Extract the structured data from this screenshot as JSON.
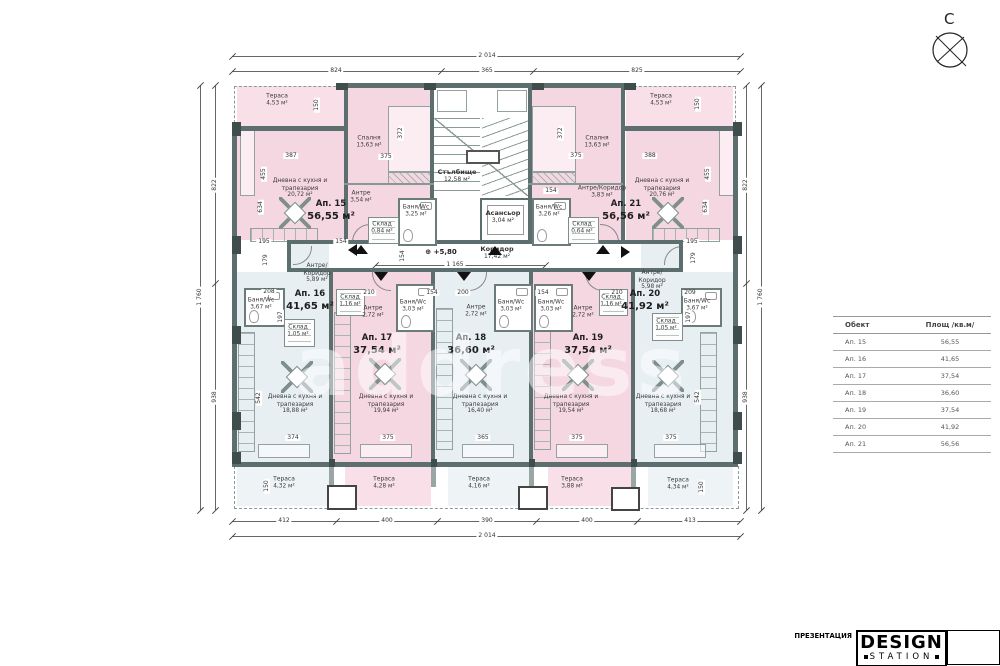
{
  "sheet": {
    "north": "С"
  },
  "watermark": "аddress",
  "core": {
    "stair": {
      "name": "Стълбище",
      "area": "12,58 м²"
    },
    "elevator": {
      "name": "Асансьор",
      "area": "3,04 м²"
    },
    "corridor": {
      "name": "Коридор",
      "area": "17,42 м²"
    },
    "level": "+5,80"
  },
  "apartments": [
    {
      "label": "Ап. 15",
      "area": "56,55 м²",
      "x": 331,
      "y": 211
    },
    {
      "label": "Ап. 16",
      "area": "41,65 м²",
      "x": 310,
      "y": 301
    },
    {
      "label": "Ап. 17",
      "area": "37,54 м²",
      "x": 377,
      "y": 345
    },
    {
      "label": "Ап. 18",
      "area": "36,60 м²",
      "x": 471,
      "y": 345
    },
    {
      "label": "Ап. 19",
      "area": "37,54 м²",
      "x": 588,
      "y": 345
    },
    {
      "label": "Ап. 20",
      "area": "41,92 м²",
      "x": 645,
      "y": 301
    },
    {
      "label": "Ап. 21",
      "area": "56,56 м²",
      "x": 626,
      "y": 211
    }
  ],
  "rooms": [
    {
      "name": "Тераса",
      "area": "4,53 м²",
      "x": 277,
      "y": 100
    },
    {
      "name": "Тераса",
      "area": "4,53 м²",
      "x": 661,
      "y": 100
    },
    {
      "name": "Спалня",
      "area": "13,63 м²",
      "x": 369,
      "y": 142
    },
    {
      "name": "Спалня",
      "area": "13,63 м²",
      "x": 597,
      "y": 142
    },
    {
      "name": "Дневна с кухня и\nтрапезария",
      "area": "20,72 м²",
      "x": 300,
      "y": 188
    },
    {
      "name": "Дневна с кухня и\nтрапезария",
      "area": "20,76 м²",
      "x": 662,
      "y": 188
    },
    {
      "name": "Антре",
      "area": "3,54 м²",
      "x": 361,
      "y": 197
    },
    {
      "name": "Антре/Коридор",
      "area": "3,83 м²",
      "x": 602,
      "y": 192
    },
    {
      "name": "Баня/Wc",
      "area": "3,25 м²",
      "x": 416,
      "y": 211
    },
    {
      "name": "Баня/Wc",
      "area": "3,26 м²",
      "x": 549,
      "y": 211
    },
    {
      "name": "Склад",
      "area": "0,84 м²",
      "x": 382,
      "y": 228
    },
    {
      "name": "Склад",
      "area": "0,64 м²",
      "x": 582,
      "y": 228
    },
    {
      "name": "Антре/\nКоридор",
      "area": "5,89 м²",
      "x": 317,
      "y": 273
    },
    {
      "name": "Антре/\nКоридор",
      "area": "5,98 м²",
      "x": 652,
      "y": 280
    },
    {
      "name": "Баня/Wc",
      "area": "3,67 м²",
      "x": 261,
      "y": 304
    },
    {
      "name": "Баня/Wc",
      "area": "3,67 м²",
      "x": 697,
      "y": 305
    },
    {
      "name": "Склад",
      "area": "1,05 м²",
      "x": 298,
      "y": 331
    },
    {
      "name": "Склад",
      "area": "1,05 м²",
      "x": 666,
      "y": 325
    },
    {
      "name": "Склад",
      "area": "1,16 м²",
      "x": 350,
      "y": 301
    },
    {
      "name": "Склад",
      "area": "1,16 м²",
      "x": 611,
      "y": 301
    },
    {
      "name": "Антре",
      "area": "2,72 м²",
      "x": 373,
      "y": 312
    },
    {
      "name": "Антре",
      "area": "2,72 м²",
      "x": 476,
      "y": 311
    },
    {
      "name": "Антре",
      "area": "2,72 м²",
      "x": 583,
      "y": 312
    },
    {
      "name": "Баня/Wc",
      "area": "3,03 м²",
      "x": 413,
      "y": 306
    },
    {
      "name": "Баня/Wc",
      "area": "3,03 м²",
      "x": 511,
      "y": 306
    },
    {
      "name": "Баня/Wc",
      "area": "3,03 м²",
      "x": 551,
      "y": 306
    },
    {
      "name": "Дневна с кухня и\nтрапезария",
      "area": "18,88 м²",
      "x": 295,
      "y": 404
    },
    {
      "name": "Дневна с кухня и\nтрапезария",
      "area": "19,94 м²",
      "x": 386,
      "y": 404
    },
    {
      "name": "Дневна с кухня и\nтрапезария",
      "area": "16,40 м²",
      "x": 480,
      "y": 404
    },
    {
      "name": "Дневна с кухня и\nтрапезария",
      "area": "19,54 м²",
      "x": 571,
      "y": 404
    },
    {
      "name": "Дневна с кухня и\nтрапезария",
      "area": "18,68 м²",
      "x": 663,
      "y": 404
    },
    {
      "name": "Тераса",
      "area": "4,32 м²",
      "x": 284,
      "y": 483
    },
    {
      "name": "Тераса",
      "area": "4,28 м²",
      "x": 384,
      "y": 483
    },
    {
      "name": "Тераса",
      "area": "4,16 м²",
      "x": 479,
      "y": 483
    },
    {
      "name": "Тераса",
      "area": "3,88 м²",
      "x": 572,
      "y": 483
    },
    {
      "name": "Тераса",
      "area": "4,34 м²",
      "x": 678,
      "y": 484
    }
  ],
  "dims": [
    {
      "t": "2 014",
      "x": 487,
      "y": 56
    },
    {
      "t": "824",
      "x": 336,
      "y": 71
    },
    {
      "t": "365",
      "x": 487,
      "y": 71
    },
    {
      "t": "825",
      "x": 637,
      "y": 71
    },
    {
      "t": "412",
      "x": 284,
      "y": 521
    },
    {
      "t": "400",
      "x": 387,
      "y": 521
    },
    {
      "t": "390",
      "x": 487,
      "y": 521
    },
    {
      "t": "400",
      "x": 587,
      "y": 521
    },
    {
      "t": "413",
      "x": 690,
      "y": 521
    },
    {
      "t": "2 014",
      "x": 487,
      "y": 536
    },
    {
      "t": "1 760",
      "x": 200,
      "y": 297,
      "v": 1
    },
    {
      "t": "822",
      "x": 215,
      "y": 185,
      "v": 1
    },
    {
      "t": "938",
      "x": 215,
      "y": 397,
      "v": 1
    },
    {
      "t": "822",
      "x": 746,
      "y": 185,
      "v": 1
    },
    {
      "t": "938",
      "x": 746,
      "y": 397,
      "v": 1
    },
    {
      "t": "1 760",
      "x": 761,
      "y": 297,
      "v": 1
    },
    {
      "t": "387",
      "x": 291,
      "y": 156
    },
    {
      "t": "375",
      "x": 386,
      "y": 157
    },
    {
      "t": "388",
      "x": 650,
      "y": 156
    },
    {
      "t": "375",
      "x": 576,
      "y": 156
    },
    {
      "t": "372",
      "x": 401,
      "y": 133,
      "v": 1
    },
    {
      "t": "372",
      "x": 561,
      "y": 133,
      "v": 1
    },
    {
      "t": "150",
      "x": 317,
      "y": 105,
      "v": 1
    },
    {
      "t": "150",
      "x": 698,
      "y": 104,
      "v": 1
    },
    {
      "t": "455",
      "x": 264,
      "y": 174,
      "v": 1
    },
    {
      "t": "634",
      "x": 261,
      "y": 207,
      "v": 1
    },
    {
      "t": "455",
      "x": 708,
      "y": 174,
      "v": 1
    },
    {
      "t": "634",
      "x": 706,
      "y": 207,
      "v": 1
    },
    {
      "t": "195",
      "x": 264,
      "y": 242
    },
    {
      "t": "154",
      "x": 341,
      "y": 242
    },
    {
      "t": "154",
      "x": 551,
      "y": 191
    },
    {
      "t": "195",
      "x": 692,
      "y": 242
    },
    {
      "t": "1 165",
      "x": 455,
      "y": 265
    },
    {
      "t": "154",
      "x": 403,
      "y": 256,
      "v": 1
    },
    {
      "t": "208",
      "x": 269,
      "y": 292
    },
    {
      "t": "210",
      "x": 369,
      "y": 293
    },
    {
      "t": "154",
      "x": 432,
      "y": 293
    },
    {
      "t": "200",
      "x": 463,
      "y": 293
    },
    {
      "t": "154",
      "x": 543,
      "y": 293
    },
    {
      "t": "210",
      "x": 617,
      "y": 293
    },
    {
      "t": "209",
      "x": 690,
      "y": 293
    },
    {
      "t": "179",
      "x": 266,
      "y": 260,
      "v": 1
    },
    {
      "t": "179",
      "x": 694,
      "y": 258,
      "v": 1
    },
    {
      "t": "197",
      "x": 281,
      "y": 317,
      "v": 1
    },
    {
      "t": "197",
      "x": 689,
      "y": 317,
      "v": 1
    },
    {
      "t": "374",
      "x": 293,
      "y": 438
    },
    {
      "t": "375",
      "x": 388,
      "y": 438
    },
    {
      "t": "365",
      "x": 483,
      "y": 438
    },
    {
      "t": "375",
      "x": 577,
      "y": 438
    },
    {
      "t": "375",
      "x": 671,
      "y": 438
    },
    {
      "t": "542",
      "x": 259,
      "y": 398,
      "v": 1
    },
    {
      "t": "542",
      "x": 698,
      "y": 397,
      "v": 1
    },
    {
      "t": "150",
      "x": 267,
      "y": 486,
      "v": 1
    },
    {
      "t": "150",
      "x": 702,
      "y": 487,
      "v": 1
    }
  ],
  "markers": [
    {
      "d": "up",
      "x": 361,
      "y": 245
    },
    {
      "d": "up",
      "x": 603,
      "y": 245
    },
    {
      "d": "up",
      "x": 495,
      "y": 246
    },
    {
      "d": "down",
      "x": 381,
      "y": 272
    },
    {
      "d": "down",
      "x": 464,
      "y": 272
    },
    {
      "d": "down",
      "x": 589,
      "y": 272
    },
    {
      "d": "left",
      "x": 348,
      "y": 250
    },
    {
      "d": "right",
      "x": 621,
      "y": 252
    }
  ],
  "area_table": {
    "headers": [
      "Обект",
      "Площ /кв.м/"
    ],
    "rows": [
      [
        "Ап. 15",
        "56,55"
      ],
      [
        "Ап. 16",
        "41,65"
      ],
      [
        "Ап. 17",
        "37,54"
      ],
      [
        "Ап. 18",
        "36,60"
      ],
      [
        "Ап. 19",
        "37,54"
      ],
      [
        "Ап. 20",
        "41,92"
      ],
      [
        "Ап. 21",
        "56,56"
      ]
    ]
  },
  "titleblock": {
    "line1": "ПРЕЗЕНТАЦИЯ",
    "line2": "ЖИЛИЩНА СГРАДА в УПИ II, кв. 64 по плана на гр.Приморско",
    "line3": "РАЗПРЕДЕЛЕНИЕ ТРЕТИ ЕТАЖ • мащаб: 1:100 • 5",
    "logo_top": "DESIGN",
    "logo_bottom": "STATION"
  }
}
